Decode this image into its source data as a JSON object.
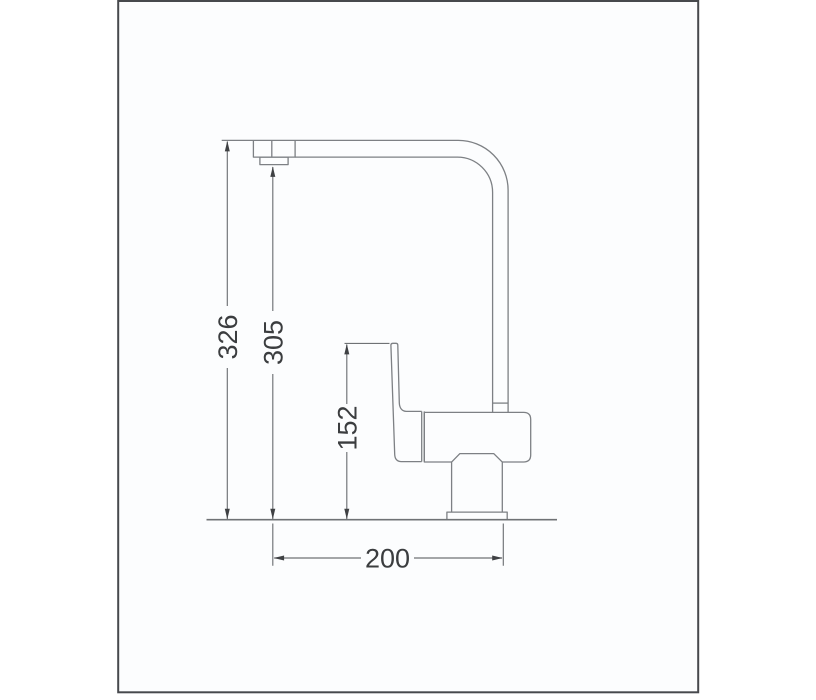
{
  "drawing": {
    "dimensions": {
      "overall_height": "326",
      "outlet_height": "305",
      "body_height": "152",
      "reach": "200"
    },
    "colors": {
      "frame_border": "#47494d",
      "canvas_background": "#fcfdfe",
      "outline_stroke": "#7d8084",
      "dimension_stroke": "#6f7275",
      "label_text": "#3b3d3f"
    }
  }
}
